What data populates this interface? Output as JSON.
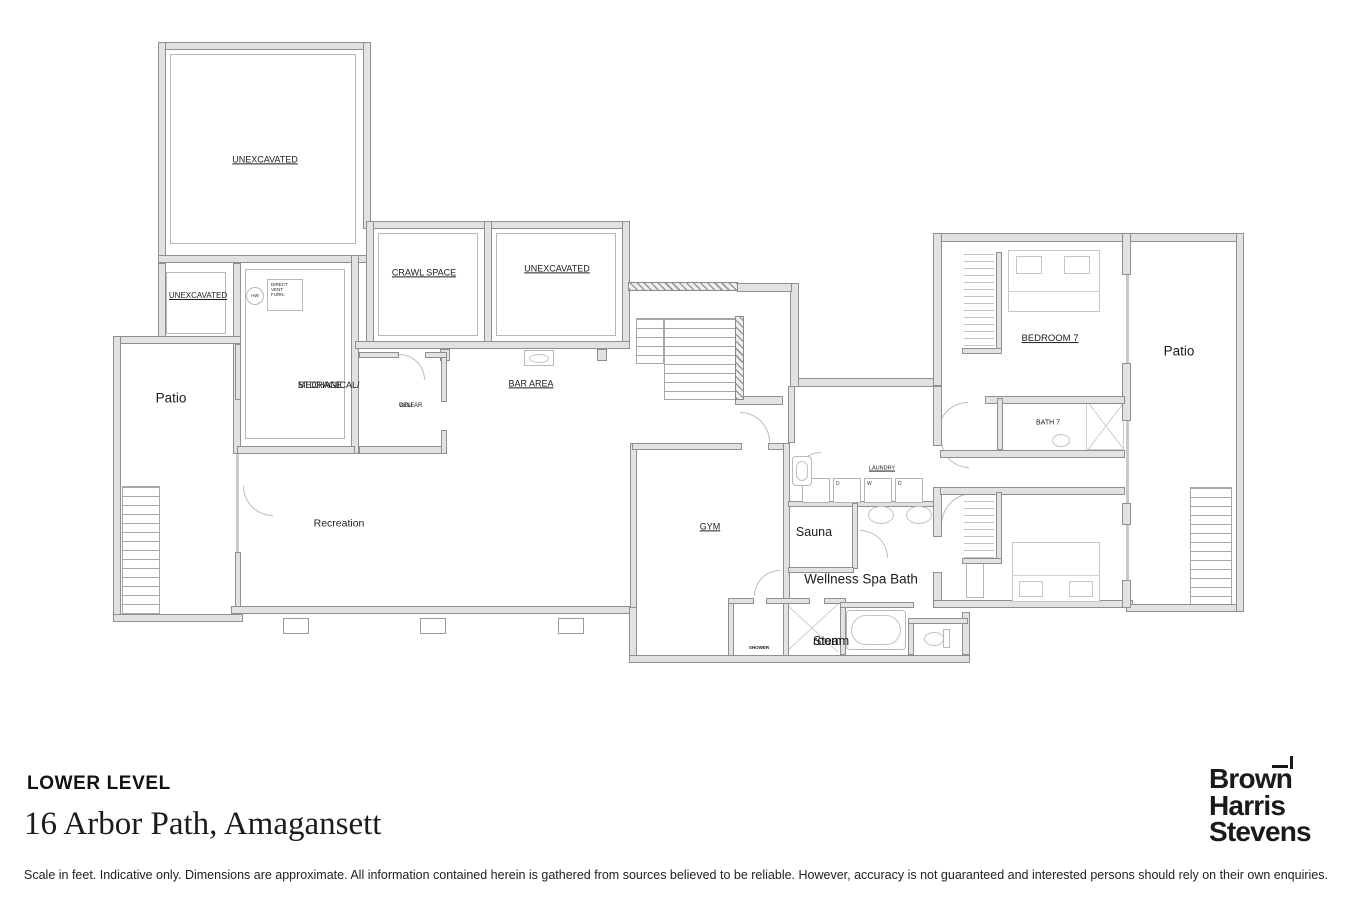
{
  "floorplan": {
    "labels": {
      "unexcavated_large": "UNEXCAVATED",
      "unexcavated_small": "UNEXCAVATED",
      "crawl_space": "CRAWL SPACE",
      "unexcavated_mid": "UNEXCAVATED",
      "mechanical_line1": "MECHANICAL/",
      "mechanical_line2": "STORAGE",
      "wine_line1": "WINE",
      "wine_line2": "CELLAR",
      "bar_area": "BAR AREA",
      "recreation": "Recreation",
      "patio_left": "Patio",
      "gym": "GYM",
      "sauna": "Sauna",
      "wellness_spa_bath": "Wellness Spa Bath",
      "steam_line1": "Steam",
      "steam_line2": "room",
      "laundry": "LAUNDRY",
      "shower": "SHOWER",
      "bedroom_7": "BEDROOM 7",
      "bath_7": "BATH 7",
      "patio_right": "Patio",
      "hw": "HW",
      "dvf_line1": "DIRECT",
      "dvf_line2": "VENT",
      "dvf_line3": "FURN.",
      "washer_1": "W",
      "dryer_1": "D",
      "washer_2": "W",
      "dryer_2": "D"
    }
  },
  "footer": {
    "level_title": "LOWER LEVEL",
    "address": "16 Arbor Path, Amagansett",
    "disclaimer": "Scale in feet. Indicative only. Dimensions are approximate. All information contained herein is gathered from sources believed to be reliable. However, accuracy is not guaranteed and interested persons should rely on their own enquiries.",
    "brand_line1": "Brown",
    "brand_line2": "Harris",
    "brand_line3": "Stevens"
  }
}
